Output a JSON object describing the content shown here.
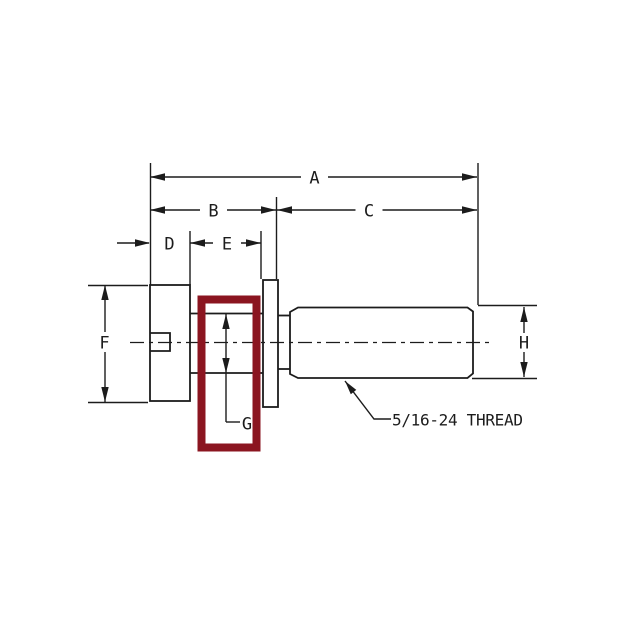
{
  "drawing": {
    "labels": {
      "a": "A",
      "b": "B",
      "c": "C",
      "d": "D",
      "e": "E",
      "f": "F",
      "g": "G",
      "h": "H"
    },
    "thread_note": "5/16-24 THREAD",
    "colors": {
      "line": "#1c1c1c",
      "highlight": "#8b1520",
      "background": "#ffffff"
    }
  }
}
